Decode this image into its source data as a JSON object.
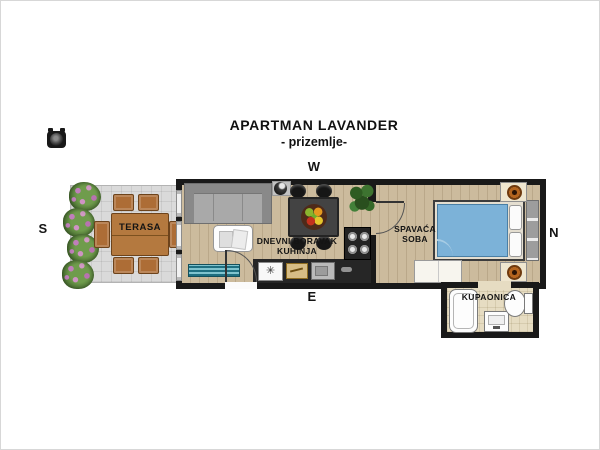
{
  "title": "APARTMAN LAVANDER",
  "subtitle": "- prizemlje-",
  "compass": {
    "west": "W",
    "south": "S",
    "east": "E",
    "north": "N"
  },
  "rooms": {
    "terrace": {
      "label": "TERASA"
    },
    "living_kitchen": {
      "line1": "DNEVNI BORAVAK",
      "line2": "KUHINJA"
    },
    "bedroom": {
      "line1": "SPAVAĆA",
      "line2": "SOBA"
    },
    "bathroom": {
      "label": "KUPAONICA"
    }
  },
  "symbols": {
    "fridge": "✳"
  },
  "furniture": {
    "terrace": [
      "dining-table",
      "6-chairs",
      "4-flower-bushes"
    ],
    "living_kitchen": [
      "corner-sofa",
      "coffee-table",
      "dining-table-with-fruit-bowl",
      "4-chairs",
      "stove",
      "sink",
      "fridge",
      "kitchen-counter",
      "plant",
      "entry-mat",
      "entrance-door"
    ],
    "bedroom": [
      "double-bed",
      "2-pillows",
      "headboard",
      "2-nightstands-with-lamps",
      "wardrobe",
      "door"
    ],
    "bathroom": [
      "bathtub",
      "washbasin",
      "toilet"
    ]
  },
  "colors": {
    "wall": "#191919",
    "wood_floor": "#ccbb9d",
    "terrace_floor": "#dadada",
    "bathroom_tile": "#e6dcc2",
    "bed_blue": "#7cb2d8",
    "terrace_wood": "#b4793f"
  }
}
